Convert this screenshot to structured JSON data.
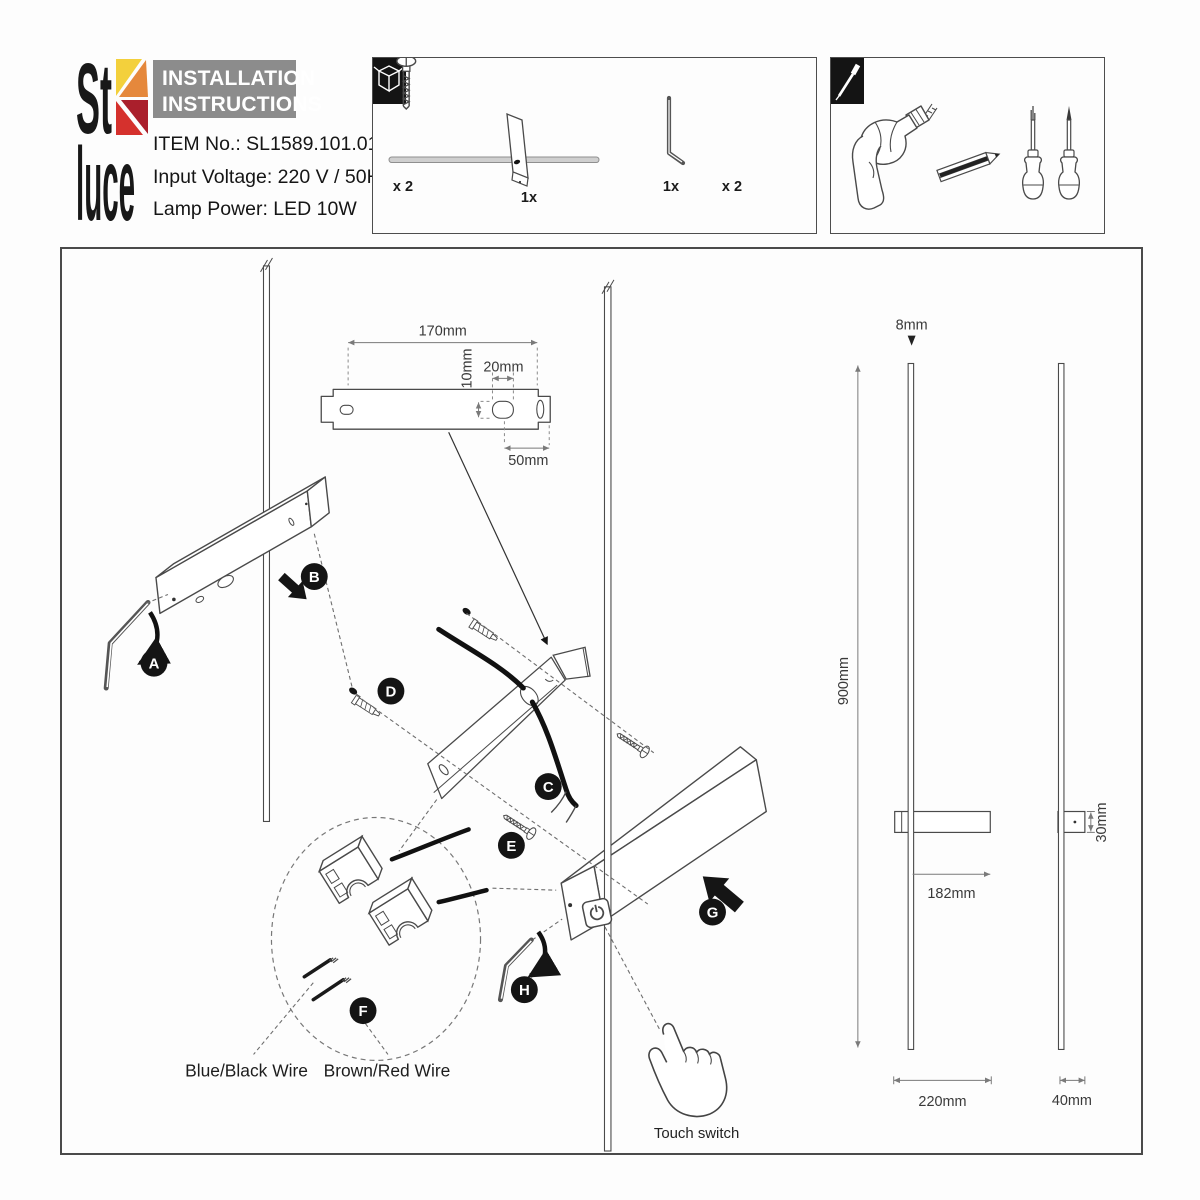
{
  "header": {
    "logo_top": "St",
    "logo_bottom": "luce",
    "title_line1": "INSTALLATION",
    "title_line2": "INSTRUCTIONS",
    "item_no": "ITEM No.: SL1589.101.01",
    "input_voltage": "Input Voltage: 220 V / 50Hz",
    "lamp_power": "Lamp Power: LED 10W"
  },
  "package_box": {
    "lamp_qty": "1x",
    "hex_key_qty": "1x",
    "anchor_qty": "x 2",
    "screw_qty": "x 2"
  },
  "steps": {
    "a": "A",
    "b": "B",
    "c": "C",
    "d": "D",
    "e": "E",
    "f": "F",
    "g": "G",
    "h": "H"
  },
  "dimensions": {
    "bracket_length": "170mm",
    "slot_height": "10mm",
    "slot_width": "20mm",
    "slot_offset": "50mm",
    "rod_height": "900mm",
    "rod_diameter": "8mm",
    "body_offset": "182mm",
    "body_length": "220mm",
    "body_height": "30mm",
    "body_depth": "40mm"
  },
  "annotations": {
    "wire_left": "Blue/Black Wire",
    "wire_right": "Brown/Red Wire",
    "touch_switch": "Touch switch"
  },
  "colors": {
    "logo_yellow": "#f3d03c",
    "logo_orange": "#e5883c",
    "logo_red": "#d5312d",
    "logo_dark_red": "#aa1f2c",
    "title_bg": "#8c8c8c"
  }
}
